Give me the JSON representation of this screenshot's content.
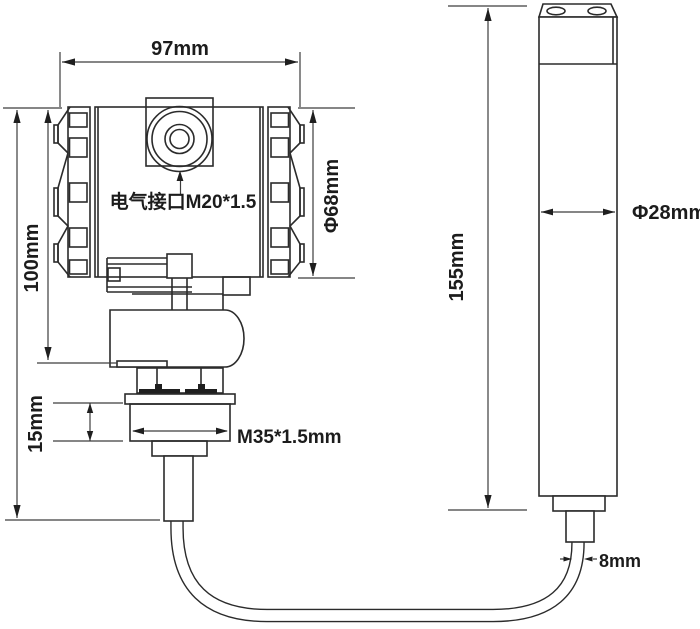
{
  "drawing": {
    "type": "technical-dimension-diagram",
    "background": "#ffffff",
    "colors": {
      "line": "#2b2b2b",
      "dimension_line": "#3d3d3d",
      "text": "#1c1c1c"
    },
    "labels": {
      "head_width": "97mm",
      "head_height": "100mm",
      "head_diameter": "Φ68mm",
      "electrical_port": "电气接口M20*1.5",
      "gland_height": "15mm",
      "thread_spec": "M35*1.5mm",
      "probe_length": "155mm",
      "probe_diameter": "Φ28mm",
      "cable_diameter": "8mm"
    }
  }
}
